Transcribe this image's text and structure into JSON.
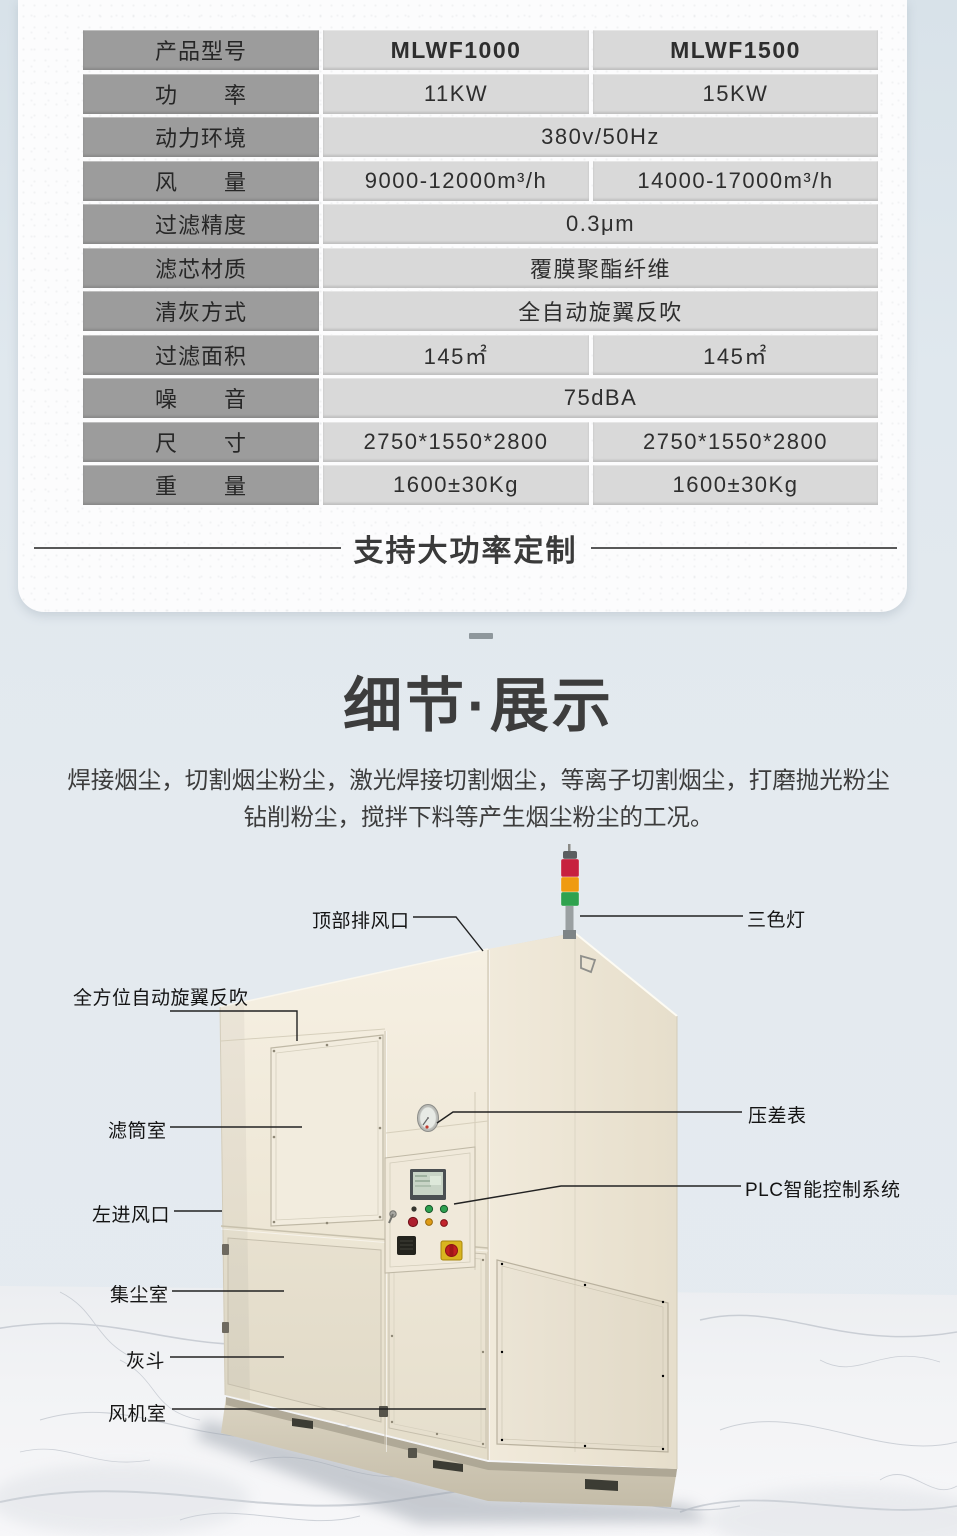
{
  "spec_table": {
    "rows": [
      {
        "label": "产品型号",
        "values": [
          "MLWF1000",
          "MLWF1500"
        ]
      },
      {
        "label": "功　　率",
        "values": [
          "11KW",
          "15KW"
        ]
      },
      {
        "label": "动力环境",
        "values": [
          "380v/50Hz"
        ]
      },
      {
        "label": "风　　量",
        "values": [
          "9000-12000m³/h",
          "14000-17000m³/h"
        ]
      },
      {
        "label": "过滤精度",
        "values": [
          "0.3μm"
        ]
      },
      {
        "label": "滤芯材质",
        "values": [
          "覆膜聚酯纤维"
        ]
      },
      {
        "label": "清灰方式",
        "values": [
          "全自动旋翼反吹"
        ]
      },
      {
        "label": "过滤面积",
        "values": [
          "145㎡",
          "145㎡"
        ]
      },
      {
        "label": "噪　　音",
        "values": [
          "75dBA"
        ]
      },
      {
        "label": "尺　　寸",
        "values": [
          "2750*1550*2800",
          "2750*1550*2800"
        ]
      },
      {
        "label": "重　　量",
        "values": [
          "1600±30Kg",
          "1600±30Kg"
        ]
      }
    ]
  },
  "banner": {
    "text": "支持大功率定制"
  },
  "detail": {
    "title": "细节·展示",
    "desc_line1": "焊接烟尘，切割烟尘粉尘，激光焊接切割烟尘，等离子切割烟尘，打磨抛光粉尘",
    "desc_line2": "钻削粉尘，搅拌下料等产生烟尘粉尘的工况。"
  },
  "photo": {
    "annotations": {
      "top_vent": "顶部排风口",
      "tricolor_light": "三色灯",
      "rotary_blowback": "全方位自动旋翼反吹",
      "filter_room": "滤筒室",
      "left_inlet": "左进风口",
      "dust_room": "集尘室",
      "ash_hopper": "灰斗",
      "fan_room": "风机室",
      "pressure_gauge": "压差表",
      "plc": "PLC智能控制系统"
    },
    "colors": {
      "light_red": "#c7213f",
      "light_orange": "#ef9b10",
      "light_green": "#2fa24f",
      "cabinet_beige": "#efe8d8"
    }
  }
}
